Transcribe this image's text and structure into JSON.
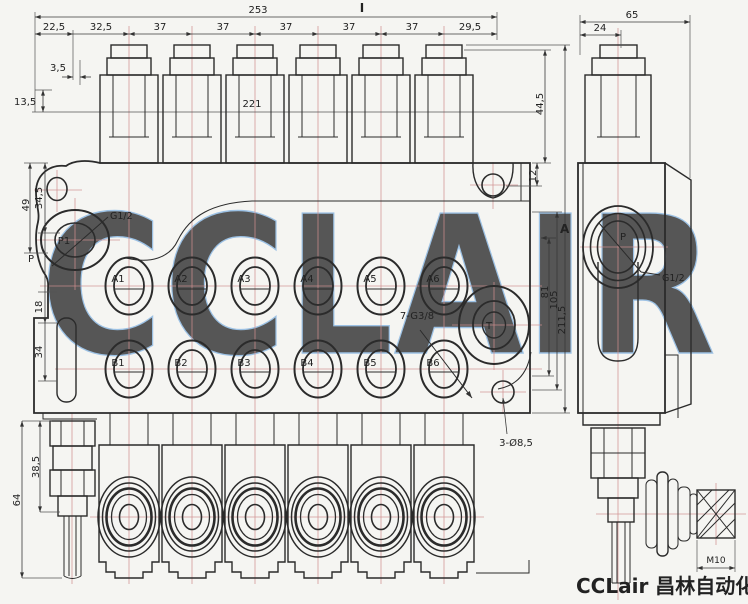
{
  "watermark": {
    "text": "CCLAIR",
    "color": "#7fb0e0"
  },
  "brand": {
    "logo_text": "CCLair 昌林自动化"
  },
  "section_markers": {
    "top": "I",
    "side": "A"
  },
  "dimensions": {
    "top": {
      "overall": "253",
      "seg_1": "22,5",
      "seg_2": "32,5",
      "pitch": [
        "37",
        "37",
        "37",
        "37",
        "37"
      ],
      "seg_right": "29,5",
      "offset_small": "3,5",
      "line_offset": "13,5",
      "body_width": "221",
      "cap_height": "44,5"
    },
    "left": {
      "d1": "34,5",
      "d2": "49",
      "port_level": "P",
      "d3": "18",
      "d4": "34"
    },
    "right": {
      "d1": "12",
      "d2": "81",
      "d3": "105",
      "d4": "211,5"
    },
    "bottom_left": {
      "d1": "38,5",
      "d2": "64"
    },
    "side": {
      "overall_width": "65",
      "cap_offset": "24",
      "handle_thread": "M10"
    }
  },
  "labels": {
    "inlet_port": "P1",
    "tank_port": "T",
    "side_port": "P",
    "inlet_thread": "G1/2",
    "side_thread": "G1/2",
    "work_ports_thread": "7-G3/8",
    "mounting_holes": "3-Ø8,5",
    "a_ports": [
      "A1",
      "A2",
      "A3",
      "A4",
      "A5",
      "A6"
    ],
    "b_ports": [
      "B1",
      "B2",
      "B3",
      "B4",
      "B5",
      "B6"
    ]
  }
}
